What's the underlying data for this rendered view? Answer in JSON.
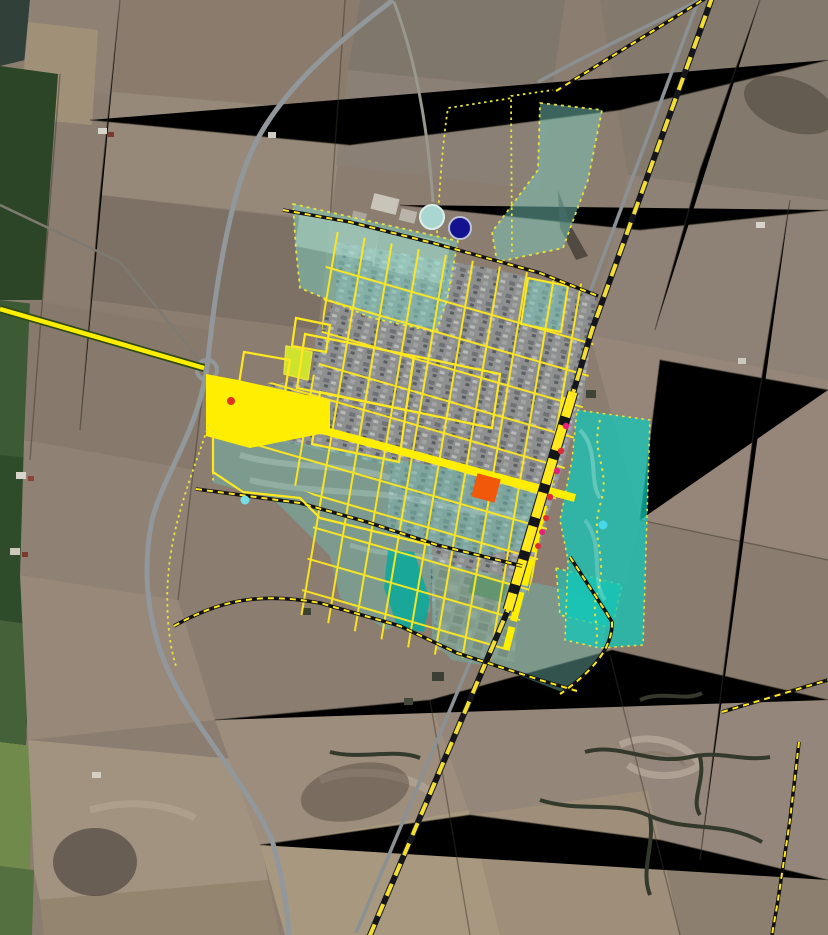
{
  "map": {
    "kind": "satellite-aerial-view-with-planning-overlay",
    "description": "Aerial/satellite view of a small grid-planned town surrounded by farmland, overlaid with yellow road network, a diagonal railway drawn with yellow-black dashes, semi-transparent teal zoning polygons, dashed planning-boundary lines and point markers.",
    "colors": {
      "road_overlay_yellow": "#ffee00",
      "street_grid_yellow": "#ffe81e",
      "railway_dash_yellow": "#f2dd35",
      "railway_casing_black": "#15161a",
      "zone_teal_muted": "rgba(110,190,176,0.5)",
      "zone_teal_bright": "rgba(14,201,186,0.72)",
      "zone_teal_dark": "rgba(0,170,158,0.8)",
      "zone_border_dotted_yellow": "#e8e33c",
      "boundary_dash_yellow": "#ffe81e",
      "parcel_chartreuse": "#cde32e",
      "plaza_orange": "#f1580a",
      "marker_navy": "#15128f",
      "marker_pale_aqua": "#a9d6d0",
      "marker_cyan": "#49d6e6",
      "marker_red": "#de2b35",
      "marker_magenta": "#e61f7d",
      "highway_gray": "#91979a",
      "farmland_brown": "#8b7d70",
      "field_green_dark": "#2c4527"
    },
    "layers": [
      {
        "name": "satellite-basemap",
        "type": "raster"
      },
      {
        "name": "zoning-polygons",
        "type": "polygon",
        "style": "teal translucent, dotted yellow border"
      },
      {
        "name": "road-network",
        "type": "line",
        "style": "solid yellow"
      },
      {
        "name": "railway",
        "type": "line",
        "style": "yellow-black dashed, thicker through town"
      },
      {
        "name": "planning-boundary",
        "type": "line",
        "style": "black-yellow dashed ring"
      },
      {
        "name": "point-markers",
        "type": "point"
      }
    ],
    "markers": [
      {
        "name": "water-tank-circle",
        "shape": "circle",
        "x": 432,
        "y": 217,
        "r": 12,
        "fill": "#a9d6d0",
        "stroke": "#dcefe9"
      },
      {
        "name": "landmark-navy-circle",
        "shape": "circle",
        "x": 460,
        "y": 228,
        "r": 11,
        "fill": "#15128f",
        "stroke": "#bcc3d6"
      },
      {
        "name": "central-plaza-square",
        "shape": "square",
        "x": 486,
        "y": 488,
        "size": 24,
        "rot": 15,
        "fill": "#f1580a"
      },
      {
        "name": "junction-red-dot",
        "shape": "circle",
        "x": 231,
        "y": 401,
        "r": 4,
        "fill": "#e03220"
      },
      {
        "name": "avenue-dot-1",
        "shape": "circle",
        "x": 566,
        "y": 426,
        "r": 3.2,
        "fill": "#e61f7d"
      },
      {
        "name": "avenue-dot-2",
        "shape": "circle",
        "x": 561,
        "y": 451,
        "r": 3.2,
        "fill": "#de2b35"
      },
      {
        "name": "avenue-dot-3",
        "shape": "circle",
        "x": 557,
        "y": 471,
        "r": 3.2,
        "fill": "#e61f7d"
      },
      {
        "name": "avenue-dot-4",
        "shape": "circle",
        "x": 550,
        "y": 497,
        "r": 3.2,
        "fill": "#de2b35"
      },
      {
        "name": "avenue-dot-5",
        "shape": "circle",
        "x": 546,
        "y": 518,
        "r": 3.0,
        "fill": "#de2b35"
      },
      {
        "name": "avenue-dot-6",
        "shape": "circle",
        "x": 542,
        "y": 532,
        "r": 3.0,
        "fill": "#e61f7d"
      },
      {
        "name": "avenue-dot-7",
        "shape": "circle",
        "x": 538,
        "y": 546,
        "r": 3.0,
        "fill": "#de2b35"
      },
      {
        "name": "west-zone-cyan-dot",
        "shape": "circle",
        "x": 245,
        "y": 500,
        "r": 4.5,
        "fill": "#79dde6"
      },
      {
        "name": "east-zone-cyan-dot",
        "shape": "circle",
        "x": 603,
        "y": 525,
        "r": 4.5,
        "fill": "#49d6e6"
      }
    ],
    "zones": [
      {
        "name": "zone-northwest",
        "fill": "rgba(125,205,188,0.5)"
      },
      {
        "name": "zone-northeast-strip",
        "fill": "rgba(120,200,185,0.5)"
      },
      {
        "name": "zone-east-bright",
        "fill": "rgba(14,201,186,0.72)"
      },
      {
        "name": "zone-southwest",
        "fill": "rgba(110,185,172,0.5)"
      },
      {
        "name": "zone-south",
        "fill": "rgba(110,185,172,0.45)"
      },
      {
        "name": "zone-dark-strip",
        "fill": "rgba(0,170,158,0.8)"
      },
      {
        "name": "parcel-chartreuse",
        "fill": "#cde32e"
      },
      {
        "name": "parcel-teal-north",
        "fill": "rgba(120,200,185,0.5)"
      }
    ]
  }
}
